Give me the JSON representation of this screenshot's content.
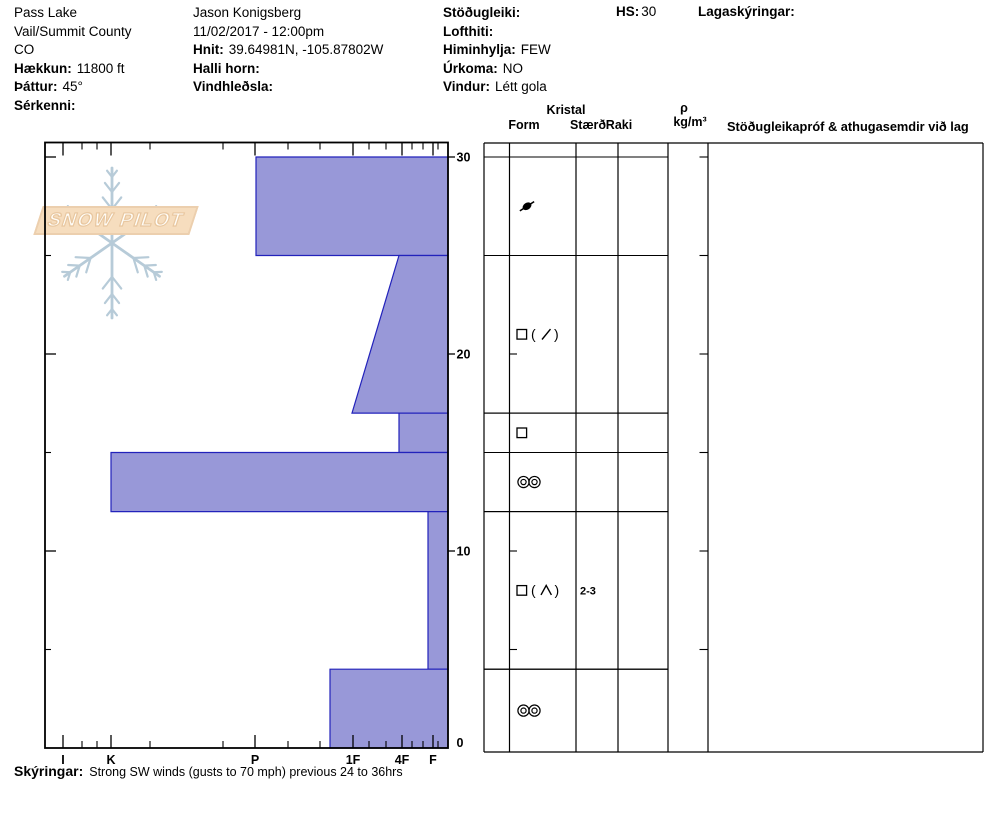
{
  "header": {
    "location": {
      "name": "Pass Lake",
      "region": "Vail/Summit County",
      "state": "CO",
      "elevation_label": "Hækkun:",
      "elevation_value": "11800 ft",
      "aspect_label": "Þáttur:",
      "aspect_value": "45°",
      "features_label": "Sérkenni:",
      "features_value": ""
    },
    "observer": {
      "name": "Jason Konigsberg",
      "datetime": "11/02/2017 - 12:00pm",
      "coords_label": "Hnit:",
      "coords_value": "39.64981N, -105.87802W",
      "slope_label": "Halli horn:",
      "slope_value": "",
      "wind_loading_label": "Vindhleðsla:",
      "wind_loading_value": ""
    },
    "conditions": {
      "stability_label": "Stöðugleiki:",
      "stability_value": "",
      "air_temp_label": "Lofthiti:",
      "air_temp_value": "",
      "sky_label": "Himinhylja:",
      "sky_value": "FEW",
      "precip_label": "Úrkoma:",
      "precip_value": "NO",
      "wind_label": "Vindur:",
      "wind_value": "Létt gola"
    },
    "hs_label": "HS:",
    "hs_value": "30",
    "layer_notes_label": "Lagaskýringar:"
  },
  "logo": {
    "text": "SNOW PILOT"
  },
  "table": {
    "group_label": "Kristal",
    "col_form": "Form",
    "col_size": "Stærð",
    "col_moisture": "Raki",
    "density_symbol": "ρ",
    "density_unit": "kg/m³",
    "tests_label": "Stöðugleikapróf & athugasemdir við lag"
  },
  "footnote": {
    "label": "Skýringar:",
    "text": "Strong SW winds (gusts to 70 mph) previous 24 to 36hrs"
  },
  "colors": {
    "bar_fill": "#9898d8",
    "bar_stroke": "#2222bb",
    "line": "#000000",
    "snowflake": "#b7cbd8",
    "banner_fill": "#f6ddbe",
    "banner_stroke": "#eccfae"
  },
  "chart_data": {
    "type": "bar",
    "title": "Snow profile — hand hardness by depth",
    "xlabel": "Hand hardness (I K P 1F 4F F)",
    "ylabel": "Depth (cm)",
    "hs_cm": 30,
    "grid": false,
    "depth_axis": {
      "min": 0,
      "max": 30,
      "major_ticks": [
        0,
        10,
        20,
        30
      ],
      "minor_ticks": [
        5,
        15,
        25
      ]
    },
    "hardness_axis": {
      "categories": [
        {
          "label": "I",
          "x_px": 63
        },
        {
          "label": "K",
          "x_px": 111
        },
        {
          "label": "P",
          "x_px": 255
        },
        {
          "label": "1F",
          "x_px": 353
        },
        {
          "label": "4F",
          "x_px": 402
        },
        {
          "label": "F",
          "x_px": 433
        }
      ],
      "minor_ticks_x_px": [
        82,
        97,
        150,
        223,
        288,
        320,
        369,
        386,
        412,
        423,
        438
      ]
    },
    "layers": [
      {
        "top_cm": 30,
        "bottom_cm": 25,
        "hardness": "P",
        "x_px": 256
      },
      {
        "top_cm": 25,
        "bottom_cm": 17,
        "hardness_top": "4F",
        "hardness_bottom": "1F",
        "x_top_px": 399,
        "x_bottom_px": 352
      },
      {
        "top_cm": 17,
        "bottom_cm": 15,
        "hardness": "4F",
        "x_px": 399
      },
      {
        "top_cm": 15,
        "bottom_cm": 12,
        "hardness": "K",
        "x_px": 111
      },
      {
        "top_cm": 12,
        "bottom_cm": 4,
        "hardness": "F+",
        "x_px": 428
      },
      {
        "top_cm": 4,
        "bottom_cm": 0,
        "hardness": "1F+",
        "x_px": 330
      }
    ],
    "grain_rows": [
      {
        "top_cm": 30,
        "bottom_cm": 25,
        "form": "DF",
        "size": "",
        "moisture": ""
      },
      {
        "top_cm": 25,
        "bottom_cm": 17,
        "form": "FC ( / )",
        "size": "",
        "moisture": ""
      },
      {
        "top_cm": 17,
        "bottom_cm": 15,
        "form": "FC",
        "size": "",
        "moisture": ""
      },
      {
        "top_cm": 15,
        "bottom_cm": 12,
        "form": "MFcr",
        "size": "",
        "moisture": ""
      },
      {
        "top_cm": 12,
        "bottom_cm": 4,
        "form": "FC ( DH )",
        "size": "2-3",
        "moisture": ""
      },
      {
        "top_cm": 4,
        "bottom_cm": 0,
        "form": "MFcr",
        "size": "",
        "moisture": ""
      }
    ],
    "density_column_ticks_cm": [
      5,
      10,
      15,
      20,
      25,
      30
    ]
  }
}
